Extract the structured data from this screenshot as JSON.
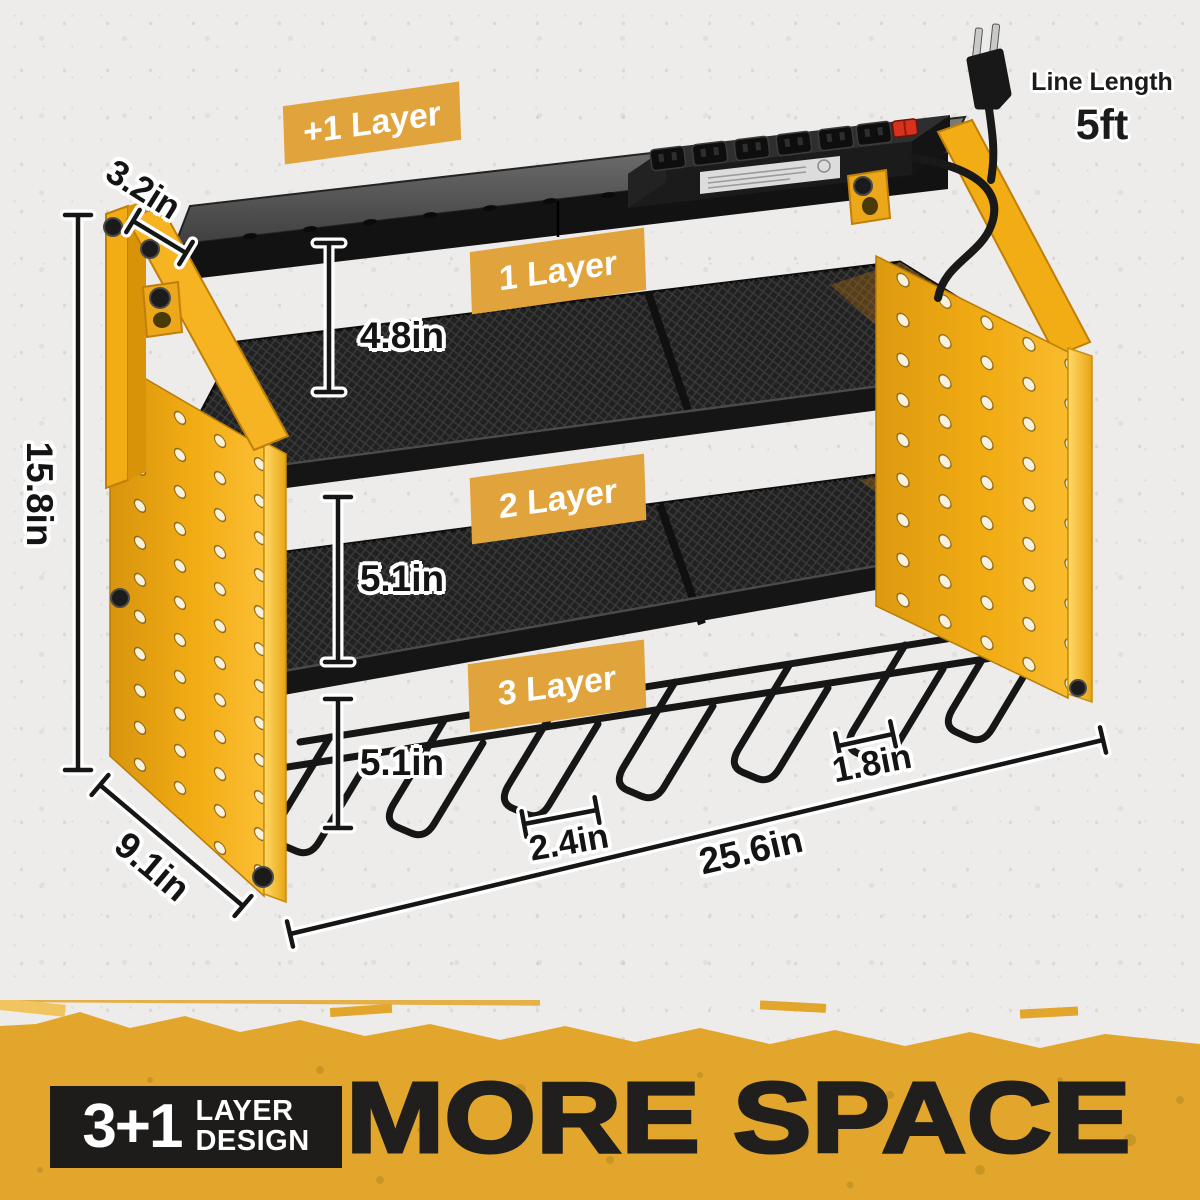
{
  "annotations": {
    "line_length": {
      "label": "Line Length",
      "value": "5ft"
    },
    "layer_badges": [
      {
        "id": "plus1",
        "label": "+1 Layer"
      },
      {
        "id": "layer1",
        "label": "1 Layer"
      },
      {
        "id": "layer2",
        "label": "2 Layer"
      },
      {
        "id": "layer3",
        "label": "3 Layer"
      }
    ],
    "dimensions": {
      "top_shelf_depth": "3.2in",
      "layer1_height": "4.8in",
      "total_height": "15.8in",
      "layer2_height": "5.1in",
      "layer3_height": "5.1in",
      "side_panel_depth": "9.1in",
      "hook_width": "2.4in",
      "hook_gap": "1.8in",
      "total_width": "25.6in"
    }
  },
  "banner": {
    "badge_number": "3+1",
    "badge_word1": "LAYER",
    "badge_word2": "DESIGN",
    "headline": "MORE SPACE"
  },
  "colors": {
    "rack_yellow": "#F2AC14",
    "badge_yellow": "#E1A33C",
    "banner_yellow": "#E3A62C",
    "ink_black": "#1C1C1C",
    "background_gray": "#EDECEA",
    "switch_red": "#D8321F"
  }
}
